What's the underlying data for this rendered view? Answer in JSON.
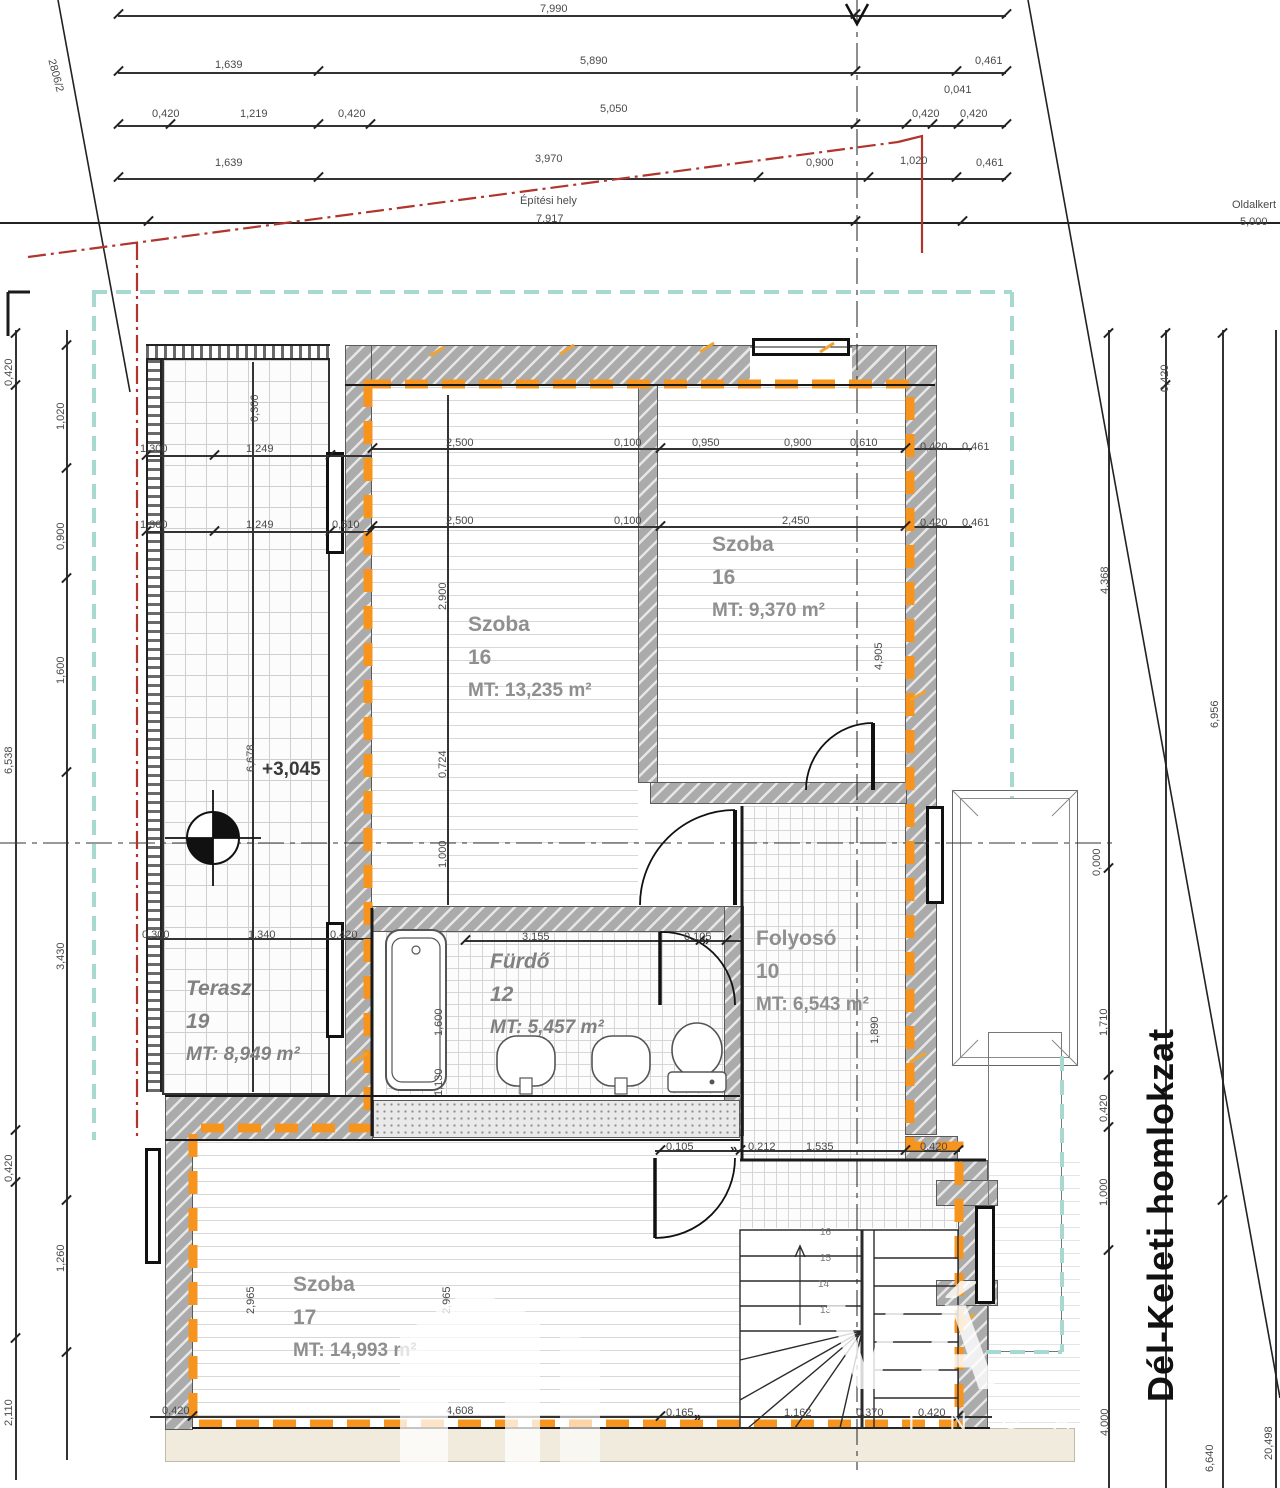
{
  "facade_label": "Dél-Keleti homlokzat",
  "site": {
    "boundary_label": "Építési hely",
    "boundary_value": "7,917",
    "side_label": "Oldalkert",
    "side_value": "5,000",
    "parcel_no": "2806/2",
    "level_mark": "+3,045",
    "datum_mark": "0,000"
  },
  "rooms": [
    {
      "name": "Szoba",
      "number": "16",
      "area": "MT: 13,235 m²"
    },
    {
      "name": "Szoba",
      "number": "16",
      "area": "MT: 9,370 m²"
    },
    {
      "name": "Terasz",
      "number": "19",
      "area": "MT: 8,949 m²"
    },
    {
      "name": "Fürdő",
      "number": "12",
      "area": "MT: 5,457 m²"
    },
    {
      "name": "Folyosó",
      "number": "10",
      "area": "MT: 6,543 m²"
    },
    {
      "name": "Szoba",
      "number": "17",
      "area": "MT: 14,993 m²"
    }
  ],
  "watermark": {
    "big": "VÁ",
    "letters": [
      "I N G A",
      "L",
      "I",
      "O"
    ]
  },
  "colors": {
    "envelope": "#F7941E",
    "boundary": "#B0352C",
    "eaves": "#A7D9D1",
    "ink": "#1a1a1a"
  },
  "dimensions": [
    [
      540,
      4,
      "7,990"
    ],
    [
      215,
      60,
      "1,639"
    ],
    [
      580,
      56,
      "5,890"
    ],
    [
      975,
      56,
      "0,461"
    ],
    [
      152,
      109,
      "0,420"
    ],
    [
      240,
      109,
      "1,219"
    ],
    [
      338,
      109,
      "0,420"
    ],
    [
      600,
      104,
      "5,050"
    ],
    [
      912,
      109,
      "0,420"
    ],
    [
      960,
      109,
      "0,420"
    ],
    [
      944,
      85,
      "0,041"
    ],
    [
      215,
      158,
      "1,639"
    ],
    [
      535,
      154,
      "3,970"
    ],
    [
      806,
      158,
      "0,900"
    ],
    [
      900,
      156,
      "1,020"
    ],
    [
      976,
      158,
      "0,461"
    ],
    [
      520,
      196,
      "Építési hely"
    ],
    [
      536,
      214,
      "7,917"
    ],
    [
      1232,
      200,
      "Oldalkert"
    ],
    [
      1240,
      217,
      "5,000"
    ],
    [
      56,
      58,
      "2806/2",
      75
    ],
    [
      4,
      352,
      "0,420",
      -90
    ],
    [
      4,
      740,
      "6,538",
      -90
    ],
    [
      4,
      1148,
      "0,420",
      -90
    ],
    [
      4,
      1392,
      "2,110",
      -90
    ],
    [
      56,
      396,
      "1,020",
      -90
    ],
    [
      56,
      516,
      "0,900",
      -90
    ],
    [
      56,
      650,
      "1,600",
      -90
    ],
    [
      56,
      936,
      "3,430",
      -90
    ],
    [
      56,
      1238,
      "1,260",
      -90
    ],
    [
      1160,
      358,
      "0,420",
      -90
    ],
    [
      1100,
      560,
      "4,368",
      -90
    ],
    [
      1210,
      694,
      "6,956",
      -90
    ],
    [
      1092,
      842,
      "0,000",
      -90
    ],
    [
      1099,
      1002,
      "1,710",
      -90
    ],
    [
      1099,
      1088,
      "0,420",
      -90
    ],
    [
      1099,
      1172,
      "1,000",
      -90
    ],
    [
      1100,
      1402,
      "4,000",
      -90
    ],
    [
      1205,
      1438,
      "6,640",
      -90
    ],
    [
      1264,
      1426,
      "20,498",
      -90
    ],
    [
      140,
      444,
      "1,300"
    ],
    [
      246,
      444,
      "1,249"
    ],
    [
      140,
      520,
      "1,300"
    ],
    [
      246,
      520,
      "1,249"
    ],
    [
      332,
      520,
      "0,610"
    ],
    [
      250,
      388,
      "0,300",
      -90
    ],
    [
      246,
      738,
      "6,678",
      -90
    ],
    [
      142,
      930,
      "0,300"
    ],
    [
      248,
      930,
      "1,340"
    ],
    [
      330,
      930,
      "0,420"
    ],
    [
      446,
      438,
      "2,500"
    ],
    [
      614,
      438,
      "0,100"
    ],
    [
      692,
      438,
      "0,950"
    ],
    [
      784,
      438,
      "0,900"
    ],
    [
      850,
      438,
      "0,610"
    ],
    [
      920,
      442,
      "0,420"
    ],
    [
      962,
      442,
      "0,461"
    ],
    [
      446,
      516,
      "2,500"
    ],
    [
      614,
      516,
      "0,100"
    ],
    [
      782,
      516,
      "2,450"
    ],
    [
      920,
      518,
      "0,420"
    ],
    [
      962,
      518,
      "0,461"
    ],
    [
      438,
      576,
      "2,900",
      -90
    ],
    [
      438,
      744,
      "0,724",
      -90
    ],
    [
      438,
      834,
      "1,000",
      -90
    ],
    [
      874,
      636,
      "4,905",
      -90
    ],
    [
      522,
      932,
      "3,155"
    ],
    [
      684,
      932,
      "0,105"
    ],
    [
      434,
      1002,
      "1,600",
      -90
    ],
    [
      434,
      1062,
      "1,130",
      -90
    ],
    [
      870,
      1010,
      "1,890",
      -90
    ],
    [
      666,
      1142,
      "0,105"
    ],
    [
      748,
      1142,
      "0,212"
    ],
    [
      806,
      1142,
      "1,535"
    ],
    [
      920,
      1142,
      "0,420"
    ],
    [
      246,
      1280,
      "2,965",
      -90
    ],
    [
      442,
      1280,
      "2,965",
      -90
    ],
    [
      162,
      1406,
      "0,420"
    ],
    [
      446,
      1406,
      "4,608"
    ],
    [
      666,
      1408,
      "0,165"
    ],
    [
      784,
      1408,
      "1,162"
    ],
    [
      856,
      1408,
      "0,370"
    ],
    [
      918,
      1408,
      "0,420"
    ],
    [
      262,
      760,
      "+3,045",
      0,
      "lvl"
    ],
    [
      820,
      1228,
      "16",
      0,
      "s"
    ],
    [
      820,
      1254,
      "15",
      0,
      "s"
    ],
    [
      818,
      1280,
      "14",
      0,
      "s"
    ],
    [
      820,
      1306,
      "13",
      0,
      "s"
    ],
    [
      702,
      934,
      "»",
      0,
      "dm"
    ],
    [
      730,
      1142,
      "»",
      0,
      "dm"
    ],
    [
      694,
      1410,
      "»",
      0,
      "dm"
    ]
  ],
  "ticks": [
    [
      118,
      14
    ],
    [
      855,
      14
    ],
    [
      1006,
      14
    ],
    [
      118,
      71
    ],
    [
      318,
      71
    ],
    [
      855,
      71
    ],
    [
      956,
      71
    ],
    [
      1006,
      71
    ],
    [
      118,
      124
    ],
    [
      170,
      124
    ],
    [
      318,
      124
    ],
    [
      370,
      124
    ],
    [
      855,
      124
    ],
    [
      906,
      124
    ],
    [
      932,
      124
    ],
    [
      958,
      124
    ],
    [
      1006,
      124
    ],
    [
      118,
      177
    ],
    [
      318,
      177
    ],
    [
      758,
      177
    ],
    [
      868,
      177
    ],
    [
      956,
      177
    ],
    [
      1006,
      177
    ],
    [
      148,
      221
    ],
    [
      855,
      221
    ],
    [
      962,
      221
    ],
    [
      15,
      333
    ],
    [
      15,
      385
    ],
    [
      15,
      1130
    ],
    [
      15,
      1182
    ],
    [
      15,
      1338
    ],
    [
      66,
      345
    ],
    [
      66,
      468
    ],
    [
      66,
      578
    ],
    [
      66,
      772
    ],
    [
      66,
      1200
    ],
    [
      66,
      1352
    ],
    [
      1108,
      333
    ],
    [
      1108,
      868
    ],
    [
      1108,
      1075
    ],
    [
      1108,
      1127
    ],
    [
      1108,
      1250
    ],
    [
      1165,
      333
    ],
    [
      1165,
      385
    ],
    [
      1222,
      333
    ],
    [
      1222,
      1200
    ],
    [
      146,
      455
    ],
    [
      214,
      455
    ],
    [
      330,
      455
    ],
    [
      146,
      531
    ],
    [
      214,
      531
    ],
    [
      330,
      531
    ],
    [
      370,
      531
    ],
    [
      372,
      448
    ],
    [
      660,
      448
    ],
    [
      905,
      448
    ],
    [
      372,
      526
    ],
    [
      660,
      526
    ],
    [
      905,
      526
    ],
    [
      465,
      940
    ],
    [
      700,
      940
    ],
    [
      726,
      940
    ],
    [
      660,
      1150
    ],
    [
      740,
      1150
    ],
    [
      905,
      1150
    ],
    [
      958,
      1150
    ],
    [
      192,
      1416
    ],
    [
      660,
      1416
    ],
    [
      958,
      1416
    ]
  ]
}
